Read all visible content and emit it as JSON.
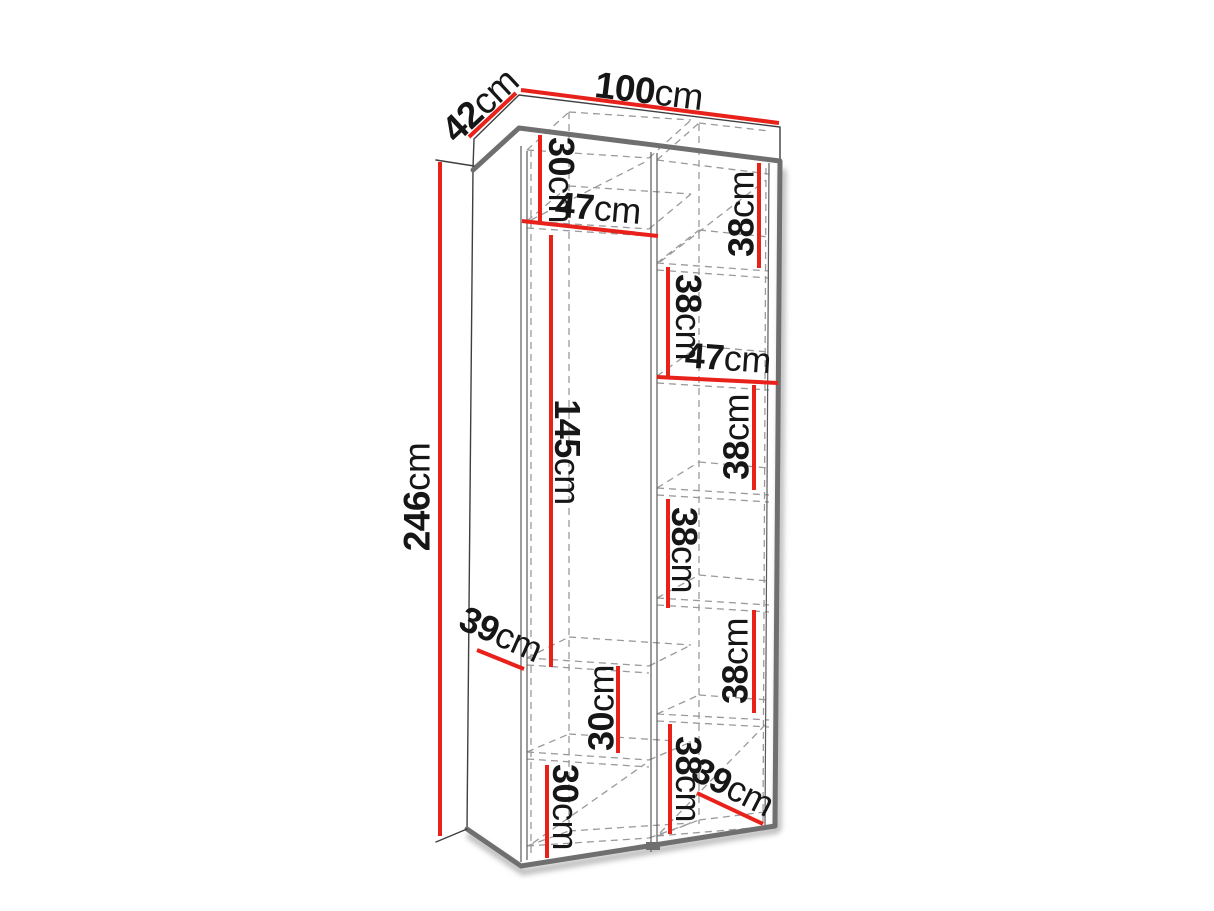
{
  "diagram": {
    "description": "Wardrobe / shelving unit dimension drawing",
    "colors": {
      "dimension_line": "#e8211b",
      "label_text": "#161616",
      "visible_edge": "#6f6f6f",
      "outline": "#3f3f3f",
      "hidden_edge": "#9a9a9a",
      "background": "#ffffff"
    },
    "labels": [
      {
        "id": "depth-top",
        "value": "42",
        "unit": "cm"
      },
      {
        "id": "width-top",
        "value": "100",
        "unit": "cm"
      },
      {
        "id": "height-left",
        "value": "246",
        "unit": "cm"
      },
      {
        "id": "left-top-section-height",
        "value": "30",
        "unit": "cm"
      },
      {
        "id": "left-column-width",
        "value": "47",
        "unit": "cm"
      },
      {
        "id": "left-middle-section-height",
        "value": "145",
        "unit": "cm"
      },
      {
        "id": "left-shelf-depth",
        "value": "39",
        "unit": "cm"
      },
      {
        "id": "left-lower-section-height",
        "value": "30",
        "unit": "cm"
      },
      {
        "id": "left-bottom-section-height",
        "value": "30",
        "unit": "cm"
      },
      {
        "id": "right-section-1-height",
        "value": "38",
        "unit": "cm"
      },
      {
        "id": "right-section-2-height",
        "value": "38",
        "unit": "cm"
      },
      {
        "id": "right-column-width",
        "value": "47",
        "unit": "cm"
      },
      {
        "id": "right-section-3-height",
        "value": "38",
        "unit": "cm"
      },
      {
        "id": "right-section-4-height",
        "value": "38",
        "unit": "cm"
      },
      {
        "id": "right-section-5-height",
        "value": "38",
        "unit": "cm"
      },
      {
        "id": "right-section-6-height",
        "value": "38",
        "unit": "cm"
      },
      {
        "id": "right-shelf-depth",
        "value": "39",
        "unit": "cm"
      }
    ]
  }
}
